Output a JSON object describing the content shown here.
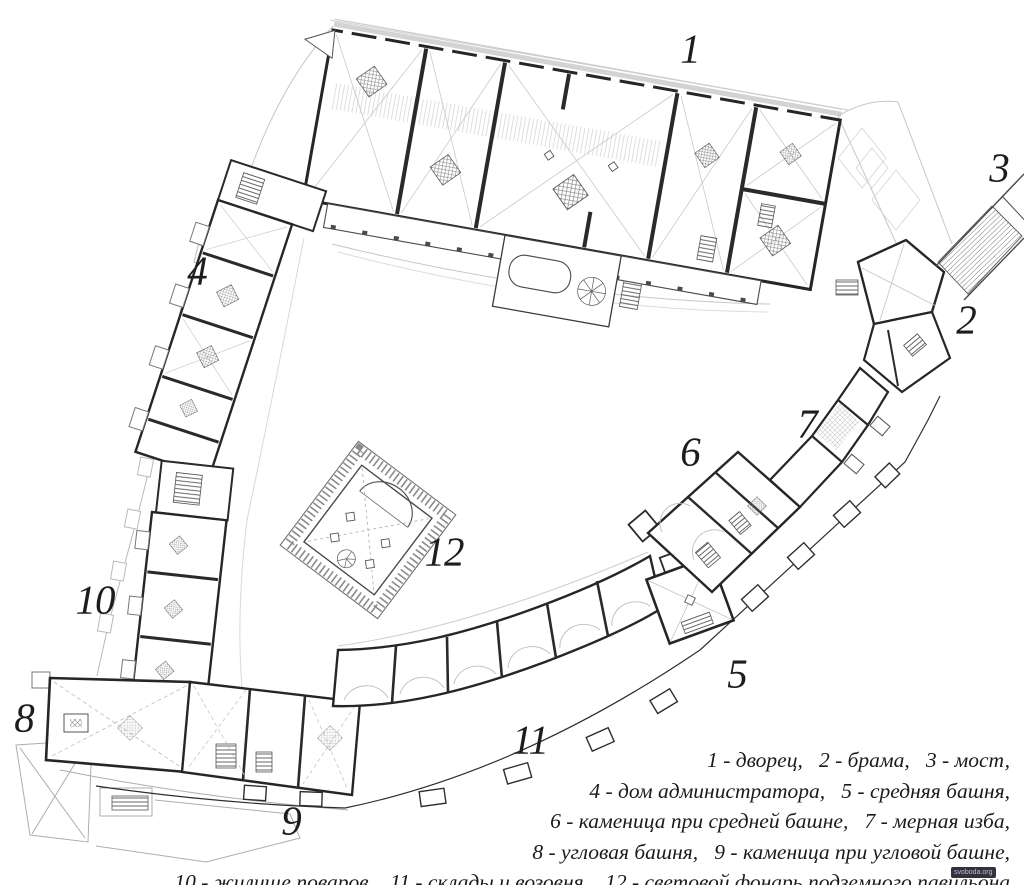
{
  "plan": {
    "description": "scanned architectural floor plan of a castle complex with numbered buildings",
    "labels": [
      "1",
      "2",
      "3",
      "4",
      "5",
      "6",
      "7",
      "8",
      "9",
      "10",
      "11",
      "12"
    ]
  },
  "legend": {
    "lines": [
      "1 - дворец,   2 - брама,   3 - мост,",
      "4 - дом администратора,   5 - средняя башня,",
      "6 - каменица при средней башне,   7 - мерная изба,",
      "8 - угловая башня,   9 - каменица при угловой башне,",
      "10 - жилище поваров,   11 - склады и возовня,   12 - световой фонарь подземного павильона"
    ],
    "items": [
      {
        "number": "1",
        "name": "дворец"
      },
      {
        "number": "2",
        "name": "брама"
      },
      {
        "number": "3",
        "name": "мост"
      },
      {
        "number": "4",
        "name": "дом администратора"
      },
      {
        "number": "5",
        "name": "средняя башня"
      },
      {
        "number": "6",
        "name": "каменица при средней башне"
      },
      {
        "number": "7",
        "name": "мерная изба"
      },
      {
        "number": "8",
        "name": "угловая башня"
      },
      {
        "number": "9",
        "name": "каменица при угловой башне"
      },
      {
        "number": "10",
        "name": "жилище поваров"
      },
      {
        "number": "11",
        "name": "склады и возовня"
      },
      {
        "number": "12",
        "name": "световой фонарь подземного павильона"
      }
    ]
  },
  "watermark": {
    "text": "svoboda.org"
  },
  "colors": {
    "background": "#ffffff",
    "ink": "#262626",
    "faint": "#c6c6c6",
    "hatch": "#8a8a8a",
    "text": "#1b1b1b"
  }
}
